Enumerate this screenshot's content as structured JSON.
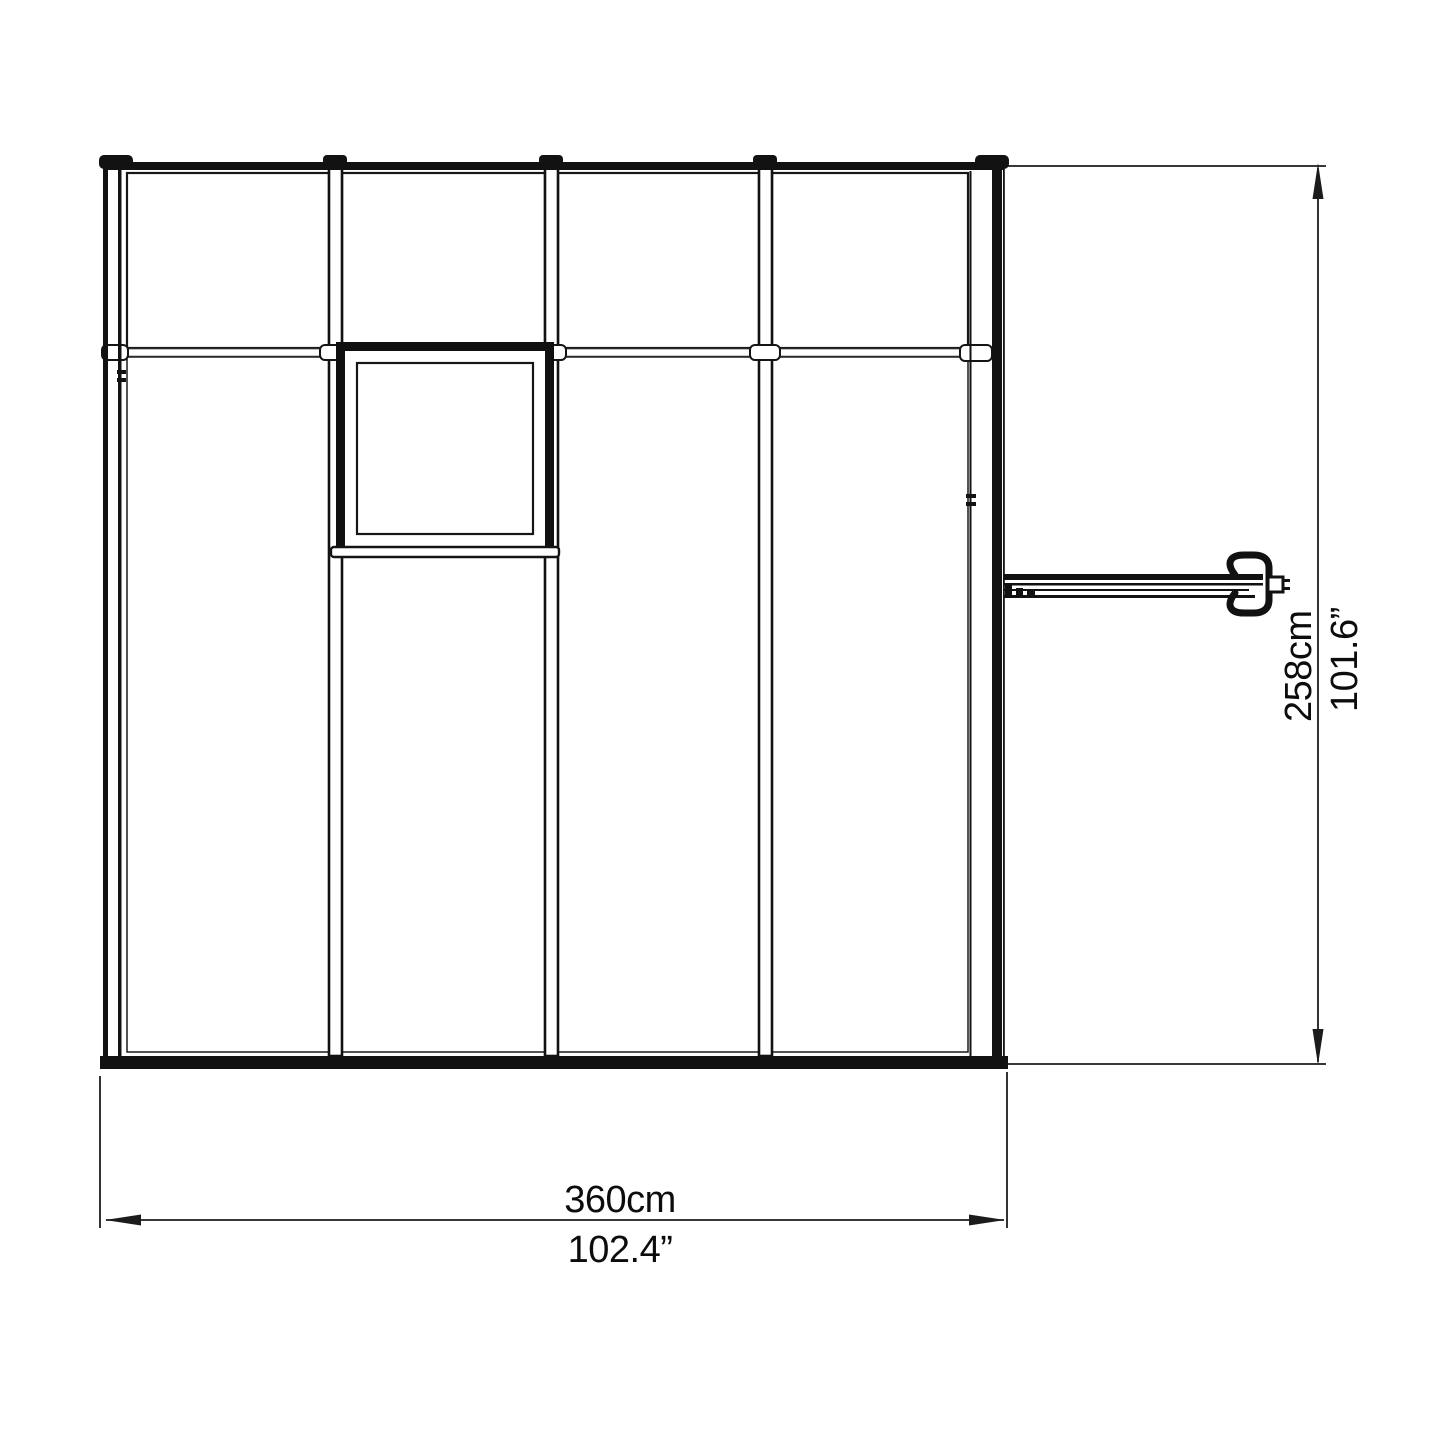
{
  "drawing": {
    "description": "greenhouse-elevation-dimension-diagram",
    "labels": {
      "width_metric": "360cm",
      "width_imperial": "102.4”",
      "height_metric": "258cm",
      "height_imperial": "101.6”"
    },
    "components": {
      "top_panel_count": 4,
      "wall_panel_count": 4,
      "has_vent_window": true,
      "has_door_handle": true
    },
    "colors": {
      "line": "#141414",
      "dimension_line": "#1c1c1c",
      "background": "#ffffff"
    }
  }
}
